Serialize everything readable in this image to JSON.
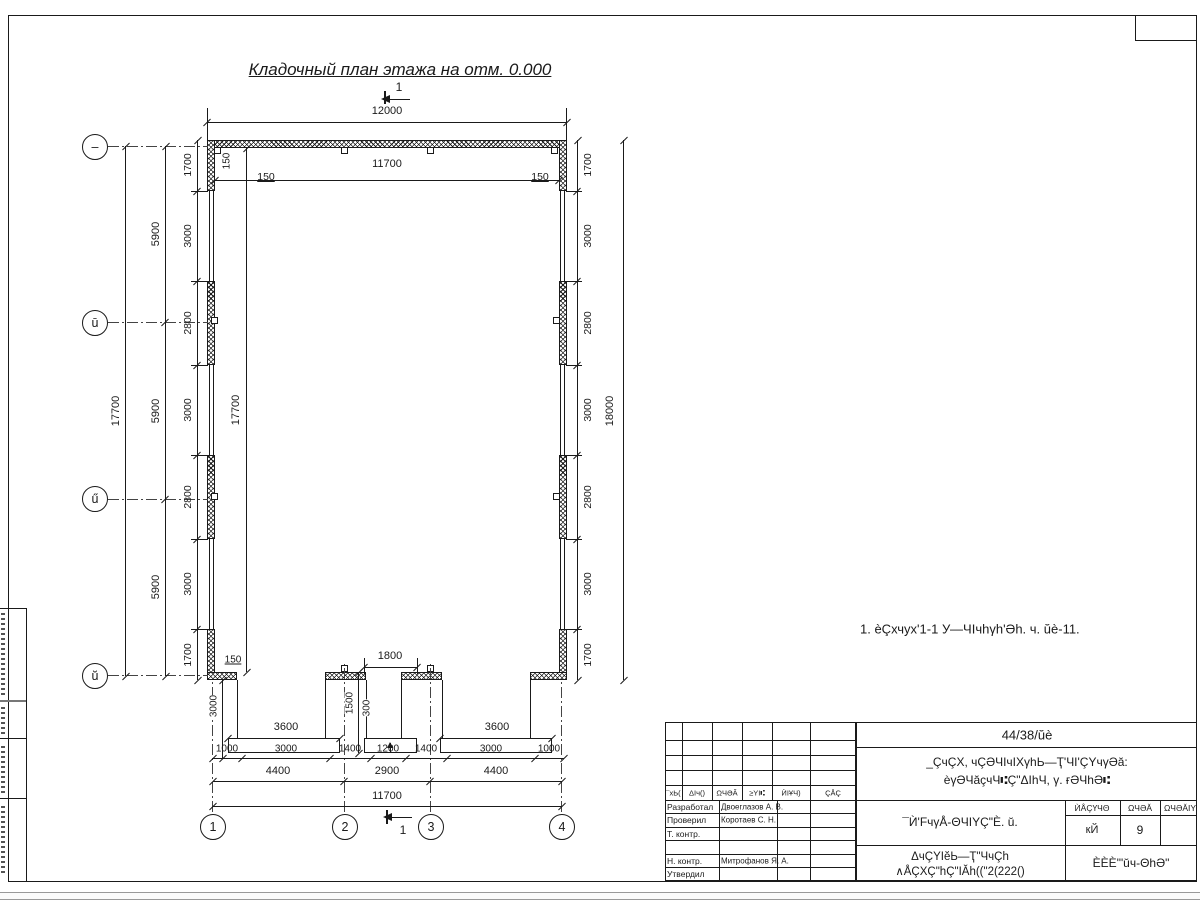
{
  "drawing": {
    "title": "Кладочный план этажа на отм. 0.000",
    "note": "1. èÇхчух'1-1 У—ЧIчhγh'Əh. ч. ŭè-11.",
    "section_label": "1"
  },
  "axes": {
    "cols": [
      "1",
      "2",
      "3",
      "4"
    ],
    "rows": [
      "–",
      "ū",
      "ű",
      "ŭ"
    ]
  },
  "dims": {
    "top_overall": "12000",
    "top_inner": "11700",
    "wall_150_vert": "150",
    "wall_150_left": "150",
    "wall_150_right": "150",
    "corner_150": "150",
    "left_overall": "17700",
    "left_inner": "17700",
    "left_spacing": [
      "5900",
      "5900",
      "5900"
    ],
    "side_chain": [
      "1700",
      "3000",
      "2800",
      "3000",
      "2800",
      "3000",
      "1700"
    ],
    "right_overall": "18000",
    "door_width": "1800",
    "porch_mid_depth": "1500",
    "step": "300",
    "porch_left_width": "3600",
    "porch_right_width": "3600",
    "porch_left_depth": "3000",
    "bottom_chain": [
      "1000",
      "3000",
      "1400",
      "1200",
      "1400",
      "3000",
      "1000"
    ],
    "bottom_spacing": [
      "4400",
      "2900",
      "4400"
    ],
    "bottom_overall": "11700"
  },
  "title_block": {
    "doc_number": "44/38/ŭè",
    "project_line1": "_ÇчÇX, чÇƏЧIчIXγhЬ—Ҭ'ЧI'ÇYчγƏă:",
    "project_line2": "èγƏЧăçчЧ⑆Ç\"ΔIhЧ, γ. ғƏЧhƏ⑆",
    "sheet_title": "¯Ѝ'FчγÅ-ΘЧIYÇ\"È. ŭ.",
    "doc_line1": "ΔчÇΥIĕЬ—Ҭ\"ЧчÇh",
    "doc_line2": "∧ÅÇXÇ\"hÇ\"IĂh((\"2(222()",
    "company": "ÈÈÈ'\"ŭч-ΘhƏ\"",
    "header_cols": [
      "¯хЬ(",
      "ΔIч()",
      "ΩЧƏĂ",
      "≥YI⑆",
      "ЍIҰЧ)",
      "ÇÅÇ"
    ],
    "stage_header": [
      "ЍÅÇҮЧΘ",
      "ΩЧƏĂ",
      "ΩЧƏĂIY"
    ],
    "stage_values": [
      "кЙ",
      "9",
      ""
    ],
    "roles": [
      {
        "label": "Разработал",
        "name": "Двоеглазов А. В."
      },
      {
        "label": "Проверил",
        "name": "Коротаев С. Н."
      },
      {
        "label": "Т. контр.",
        "name": ""
      },
      {
        "label": "",
        "name": ""
      },
      {
        "label": "Н. контр.",
        "name": "Митрофанов Я. А."
      },
      {
        "label": "Утвердил",
        "name": ""
      }
    ]
  }
}
